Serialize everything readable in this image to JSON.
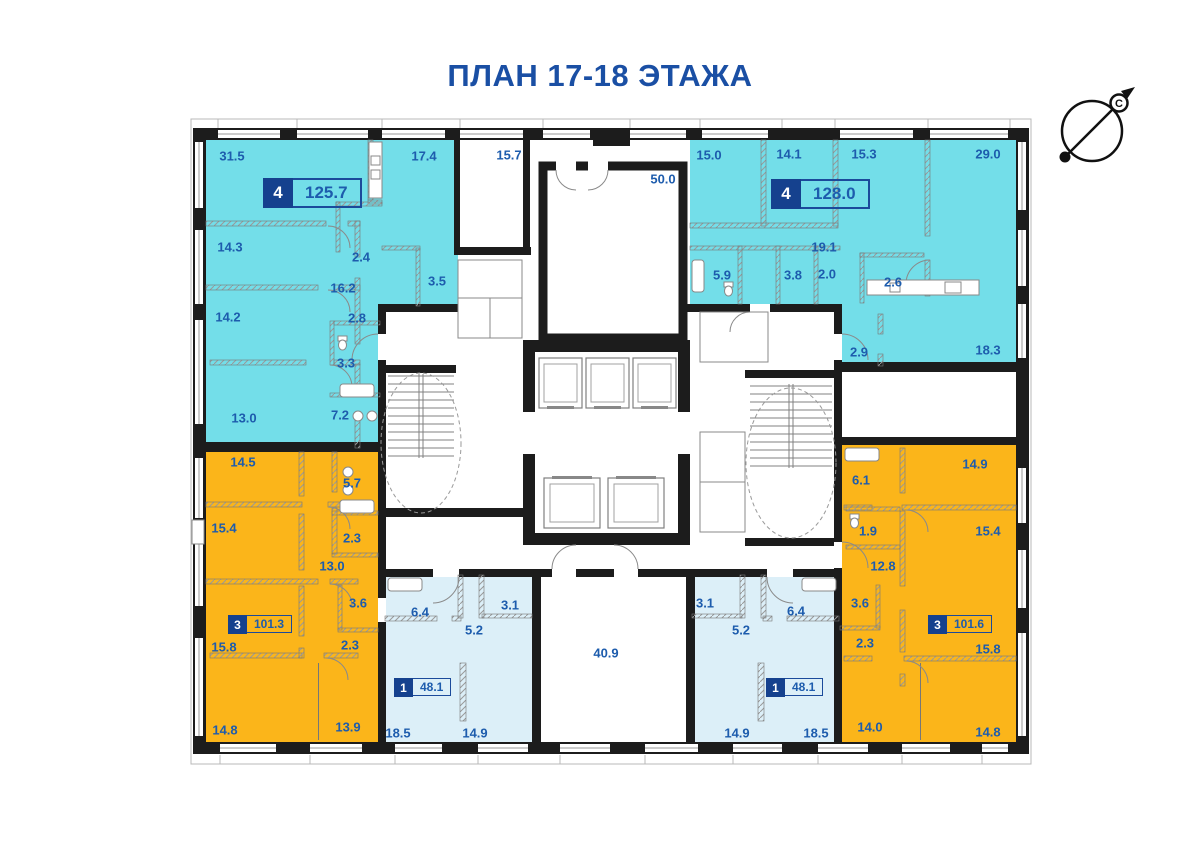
{
  "title": {
    "text": "ПЛАН 17-18 ЭТАЖА"
  },
  "compass": {
    "north_letter": "С"
  },
  "colors": {
    "title_text": "#1A4FA4",
    "label_text": "#1D5CAD",
    "badge_fill": "#15418E",
    "badge_border": "#1B4A9B",
    "apartment_4_room": "#73DEE9",
    "apartment_3_room": "#FBB51A",
    "apartment_1_room": "#DCEFF8",
    "walls": "#1C1C1C"
  },
  "plan": {
    "apartments": [
      {
        "id": "top-left",
        "rooms": "4",
        "area": "125.7",
        "badge": {
          "x": 263,
          "y": 178,
          "size": "large"
        },
        "room_areas": [
          {
            "t": "31.5",
            "x": 232,
            "y": 156
          },
          {
            "t": "17.4",
            "x": 424,
            "y": 156
          },
          {
            "t": "14.3",
            "x": 230,
            "y": 247
          },
          {
            "t": "2.4",
            "x": 361,
            "y": 257
          },
          {
            "t": "3.5",
            "x": 437,
            "y": 281
          },
          {
            "t": "16.2",
            "x": 343,
            "y": 288
          },
          {
            "t": "14.2",
            "x": 228,
            "y": 317
          },
          {
            "t": "2.8",
            "x": 357,
            "y": 318
          },
          {
            "t": "3.3",
            "x": 346,
            "y": 363
          },
          {
            "t": "7.2",
            "x": 340,
            "y": 415
          },
          {
            "t": "13.0",
            "x": 244,
            "y": 418
          }
        ]
      },
      {
        "id": "top-right",
        "rooms": "4",
        "area": "128.0",
        "badge": {
          "x": 771,
          "y": 179,
          "size": "large"
        },
        "room_areas": [
          {
            "t": "15.0",
            "x": 709,
            "y": 155
          },
          {
            "t": "14.1",
            "x": 789,
            "y": 154
          },
          {
            "t": "15.3",
            "x": 864,
            "y": 154
          },
          {
            "t": "29.0",
            "x": 988,
            "y": 154
          },
          {
            "t": "19.1",
            "x": 824,
            "y": 247
          },
          {
            "t": "5.9",
            "x": 722,
            "y": 275
          },
          {
            "t": "3.8",
            "x": 793,
            "y": 275
          },
          {
            "t": "2.0",
            "x": 827,
            "y": 274
          },
          {
            "t": "2.6",
            "x": 893,
            "y": 282
          },
          {
            "t": "2.9",
            "x": 859,
            "y": 352
          },
          {
            "t": "18.3",
            "x": 988,
            "y": 350
          }
        ]
      },
      {
        "id": "bottom-left",
        "rooms": "3",
        "area": "101.3",
        "badge": {
          "x": 228,
          "y": 615,
          "size": "small"
        },
        "room_areas": [
          {
            "t": "14.5",
            "x": 243,
            "y": 462
          },
          {
            "t": "5.7",
            "x": 352,
            "y": 483
          },
          {
            "t": "15.4",
            "x": 224,
            "y": 528
          },
          {
            "t": "2.3",
            "x": 352,
            "y": 538
          },
          {
            "t": "13.0",
            "x": 332,
            "y": 566
          },
          {
            "t": "3.6",
            "x": 358,
            "y": 603
          },
          {
            "t": "15.8",
            "x": 224,
            "y": 647
          },
          {
            "t": "2.3",
            "x": 350,
            "y": 645
          },
          {
            "t": "14.8",
            "x": 225,
            "y": 730
          },
          {
            "t": "13.9",
            "x": 348,
            "y": 727
          }
        ]
      },
      {
        "id": "bottom-middle-left",
        "rooms": "1",
        "area": "48.1",
        "badge": {
          "x": 394,
          "y": 678,
          "size": "small"
        },
        "room_areas": [
          {
            "t": "6.4",
            "x": 420,
            "y": 612
          },
          {
            "t": "3.1",
            "x": 510,
            "y": 605
          },
          {
            "t": "5.2",
            "x": 474,
            "y": 630
          },
          {
            "t": "18.5",
            "x": 398,
            "y": 733
          },
          {
            "t": "14.9",
            "x": 475,
            "y": 733
          }
        ]
      },
      {
        "id": "bottom-middle-right",
        "rooms": "1",
        "area": "48.1",
        "badge": {
          "x": 766,
          "y": 678,
          "size": "small"
        },
        "room_areas": [
          {
            "t": "3.1",
            "x": 705,
            "y": 603
          },
          {
            "t": "6.4",
            "x": 796,
            "y": 611
          },
          {
            "t": "5.2",
            "x": 741,
            "y": 630
          },
          {
            "t": "14.9",
            "x": 737,
            "y": 733
          },
          {
            "t": "18.5",
            "x": 816,
            "y": 733
          }
        ]
      },
      {
        "id": "bottom-right",
        "rooms": "3",
        "area": "101.6",
        "badge": {
          "x": 928,
          "y": 615,
          "size": "small"
        },
        "room_areas": [
          {
            "t": "14.9",
            "x": 975,
            "y": 464
          },
          {
            "t": "6.1",
            "x": 861,
            "y": 480
          },
          {
            "t": "1.9",
            "x": 868,
            "y": 531
          },
          {
            "t": "15.4",
            "x": 988,
            "y": 531
          },
          {
            "t": "12.8",
            "x": 883,
            "y": 566
          },
          {
            "t": "3.6",
            "x": 860,
            "y": 603
          },
          {
            "t": "2.3",
            "x": 865,
            "y": 643
          },
          {
            "t": "15.8",
            "x": 988,
            "y": 649
          },
          {
            "t": "14.0",
            "x": 870,
            "y": 727
          },
          {
            "t": "14.8",
            "x": 988,
            "y": 732
          }
        ]
      }
    ],
    "common_areas": [
      {
        "t": "15.7",
        "x": 509,
        "y": 155
      },
      {
        "t": "50.0",
        "x": 663,
        "y": 179
      },
      {
        "t": "40.9",
        "x": 606,
        "y": 653
      }
    ]
  }
}
